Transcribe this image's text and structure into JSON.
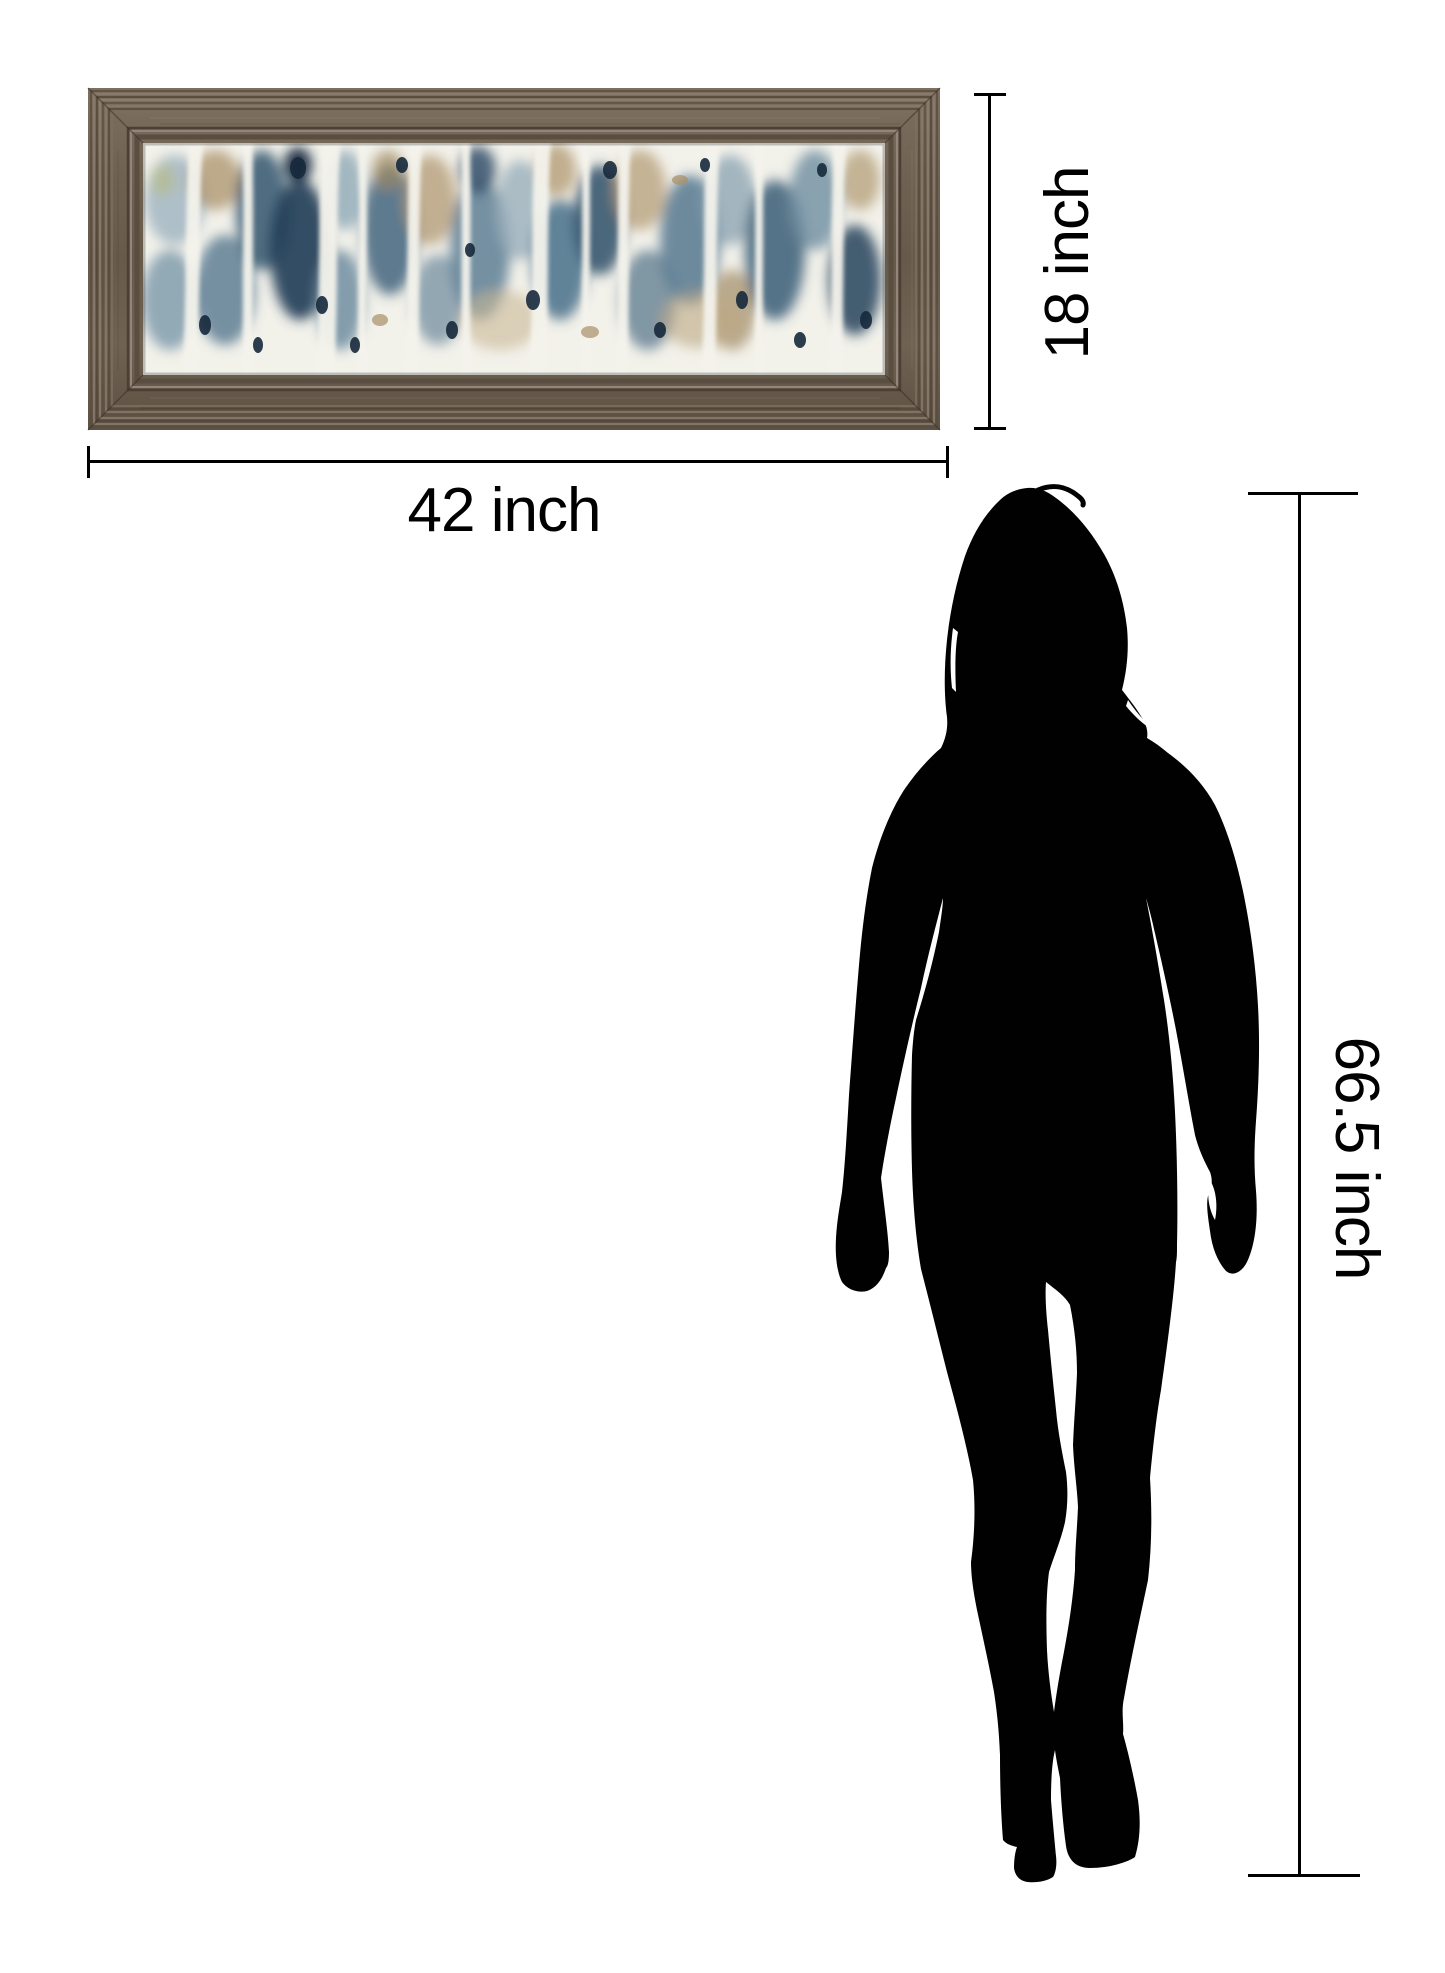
{
  "page": {
    "background": "#ffffff"
  },
  "artwork": {
    "frame_color": "#6d6051",
    "frame_ridge_dark": "#54483a",
    "frame_ridge_light": "#8b7d6e",
    "canvas_background": "#f2f1ea",
    "palette": [
      "#9db3c0",
      "#56788f",
      "#1f3c55",
      "#a78c63",
      "#c9b795",
      "#16293c",
      "#f4f3ec"
    ]
  },
  "person": {
    "silhouette_color": "#000000"
  },
  "dimensions": {
    "width": {
      "label": "42 inch",
      "value": 42,
      "unit": "inch"
    },
    "height": {
      "label": "18 inch",
      "value": 18,
      "unit": "inch"
    },
    "person_height": {
      "label": "66.5 inch",
      "value": 66.5,
      "unit": "inch"
    }
  }
}
